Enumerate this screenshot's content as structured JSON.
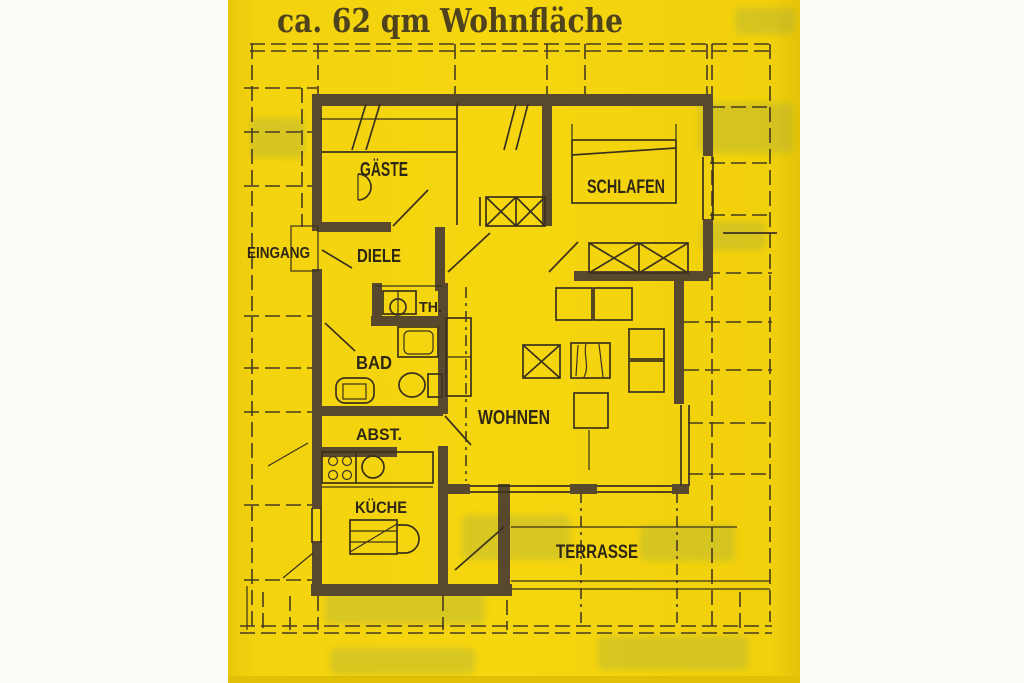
{
  "title": {
    "text": "ca. 62 qm Wohnfläche",
    "color": "#4e431d"
  },
  "paper": {
    "color": "#f2d10d",
    "edge_color": "#dcbf09",
    "background": "#fbfbf8"
  },
  "plan": {
    "wall_color": "#57482e",
    "line_color": "#3a311d",
    "label_color": "#2f2715",
    "rooms": [
      {
        "id": "gaeste",
        "label": "GÄSTE"
      },
      {
        "id": "schlafen",
        "label": "SCHLAFEN"
      },
      {
        "id": "eingang",
        "label": "EINGANG"
      },
      {
        "id": "diele",
        "label": "DIELE"
      },
      {
        "id": "th",
        "label": "TH."
      },
      {
        "id": "bad",
        "label": "BAD"
      },
      {
        "id": "abst",
        "label": "ABST."
      },
      {
        "id": "kueche",
        "label": "KÜCHE"
      },
      {
        "id": "wohnen",
        "label": "WOHNEN"
      },
      {
        "id": "terrasse",
        "label": "TERRASSE"
      }
    ]
  }
}
